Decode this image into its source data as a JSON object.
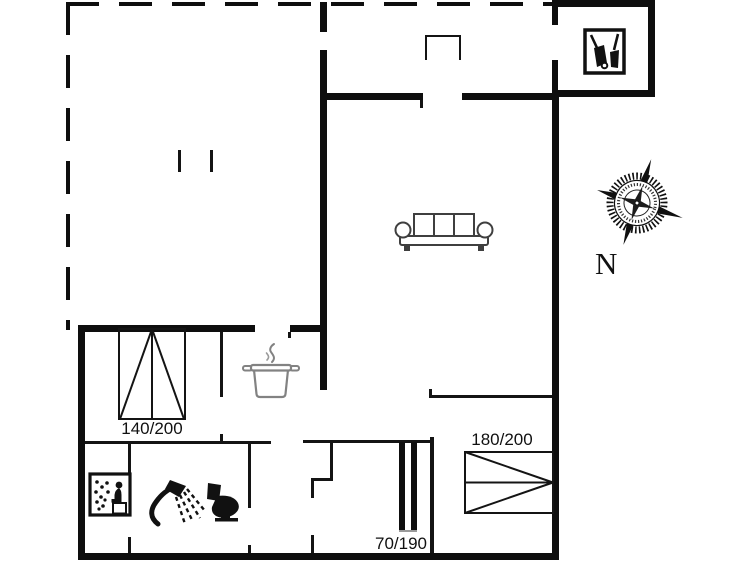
{
  "floor_plan": {
    "background_color": "#ffffff",
    "wall_color": "#0e0e0e",
    "sofa_gray": "#3f3f3f",
    "pot_gray": "#828282",
    "beds": [
      {
        "name": "double-bed-left",
        "label": "140/200"
      },
      {
        "name": "double-bed-right",
        "label": "180/200"
      },
      {
        "name": "bunk-bed",
        "label": "70/190"
      }
    ],
    "compass": {
      "label": "N"
    },
    "icons": {
      "sofa": "sofa-icon",
      "cooking_pot": "cooking-pot-icon",
      "sauna": "sauna-icon",
      "shower": "shower-icon",
      "toilet": "toilet-icon",
      "garden_tools": "garden-tools-icon",
      "compass_rose": "compass-rose-icon",
      "entrance_step": "entrance-step-icon"
    }
  }
}
